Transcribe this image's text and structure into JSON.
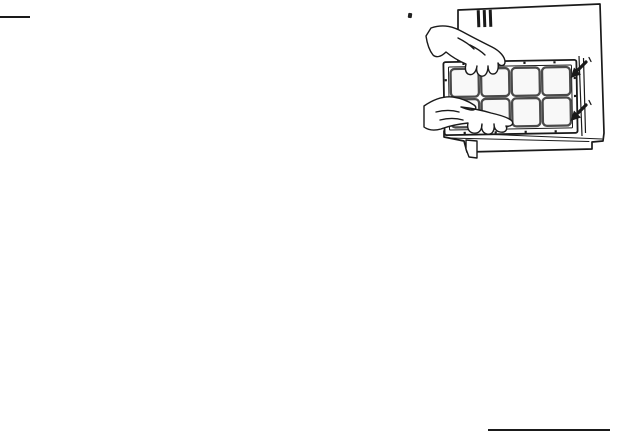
{
  "page": {
    "type": "scanned-manual-page",
    "background_color": "#ffffff",
    "ink_color": "#1a1a1a"
  },
  "rules": {
    "top_left_rule": "horizontal divider line",
    "bottom_right_rule": "horizontal divider line"
  },
  "figure": {
    "alt": "Two hands holding a rectangular air filter with a 4 by 2 grid of cells, fitting it onto the side panel of an appliance; louvered vent slots at the top and two small arrows marking the mounting points on the right edge.",
    "grid_rows": 2,
    "grid_columns": 4,
    "arrow_count": 2,
    "vent_slot_count": 3
  }
}
